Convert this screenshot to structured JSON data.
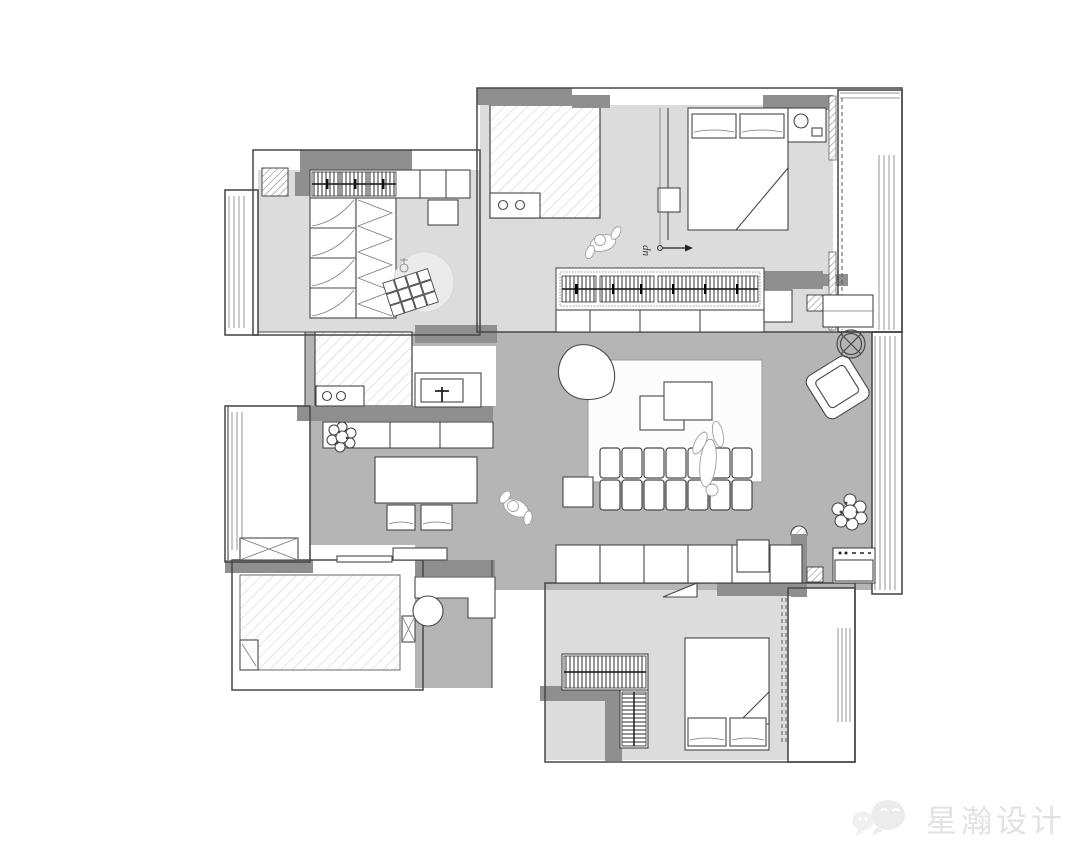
{
  "watermark": {
    "brand_text": "星瀚设计",
    "icon": "wechat-bubbles-icon"
  },
  "plan": {
    "stair_label": "up"
  },
  "colors": {
    "wall": "#8f8f8f",
    "floorMain": "#b5b5b5",
    "floorRoom": "#dcdcdc",
    "line": "#474747",
    "hatchLight": "#cbcbcb",
    "hatchDark": "#8f8f8f",
    "watermark": "#e2e2e2"
  }
}
